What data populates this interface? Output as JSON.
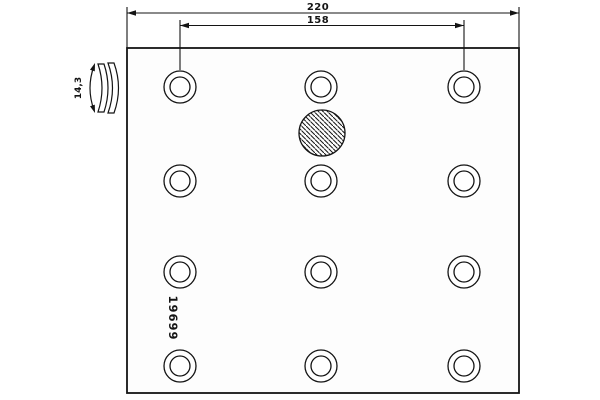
{
  "drawing": {
    "kind": "brake-lining-technical-drawing",
    "part_number": "19699",
    "dimensions": {
      "overall_width_label": "220",
      "hole_spacing_label": "158",
      "thickness_label": "14,3"
    },
    "features": {
      "rivet_hole_count": 12,
      "rivet_hole_columns": 3,
      "rivet_hole_rows": 4,
      "hatched_hole_present": true
    },
    "colors": {
      "line": "#141414",
      "background": "#ffffff"
    }
  }
}
